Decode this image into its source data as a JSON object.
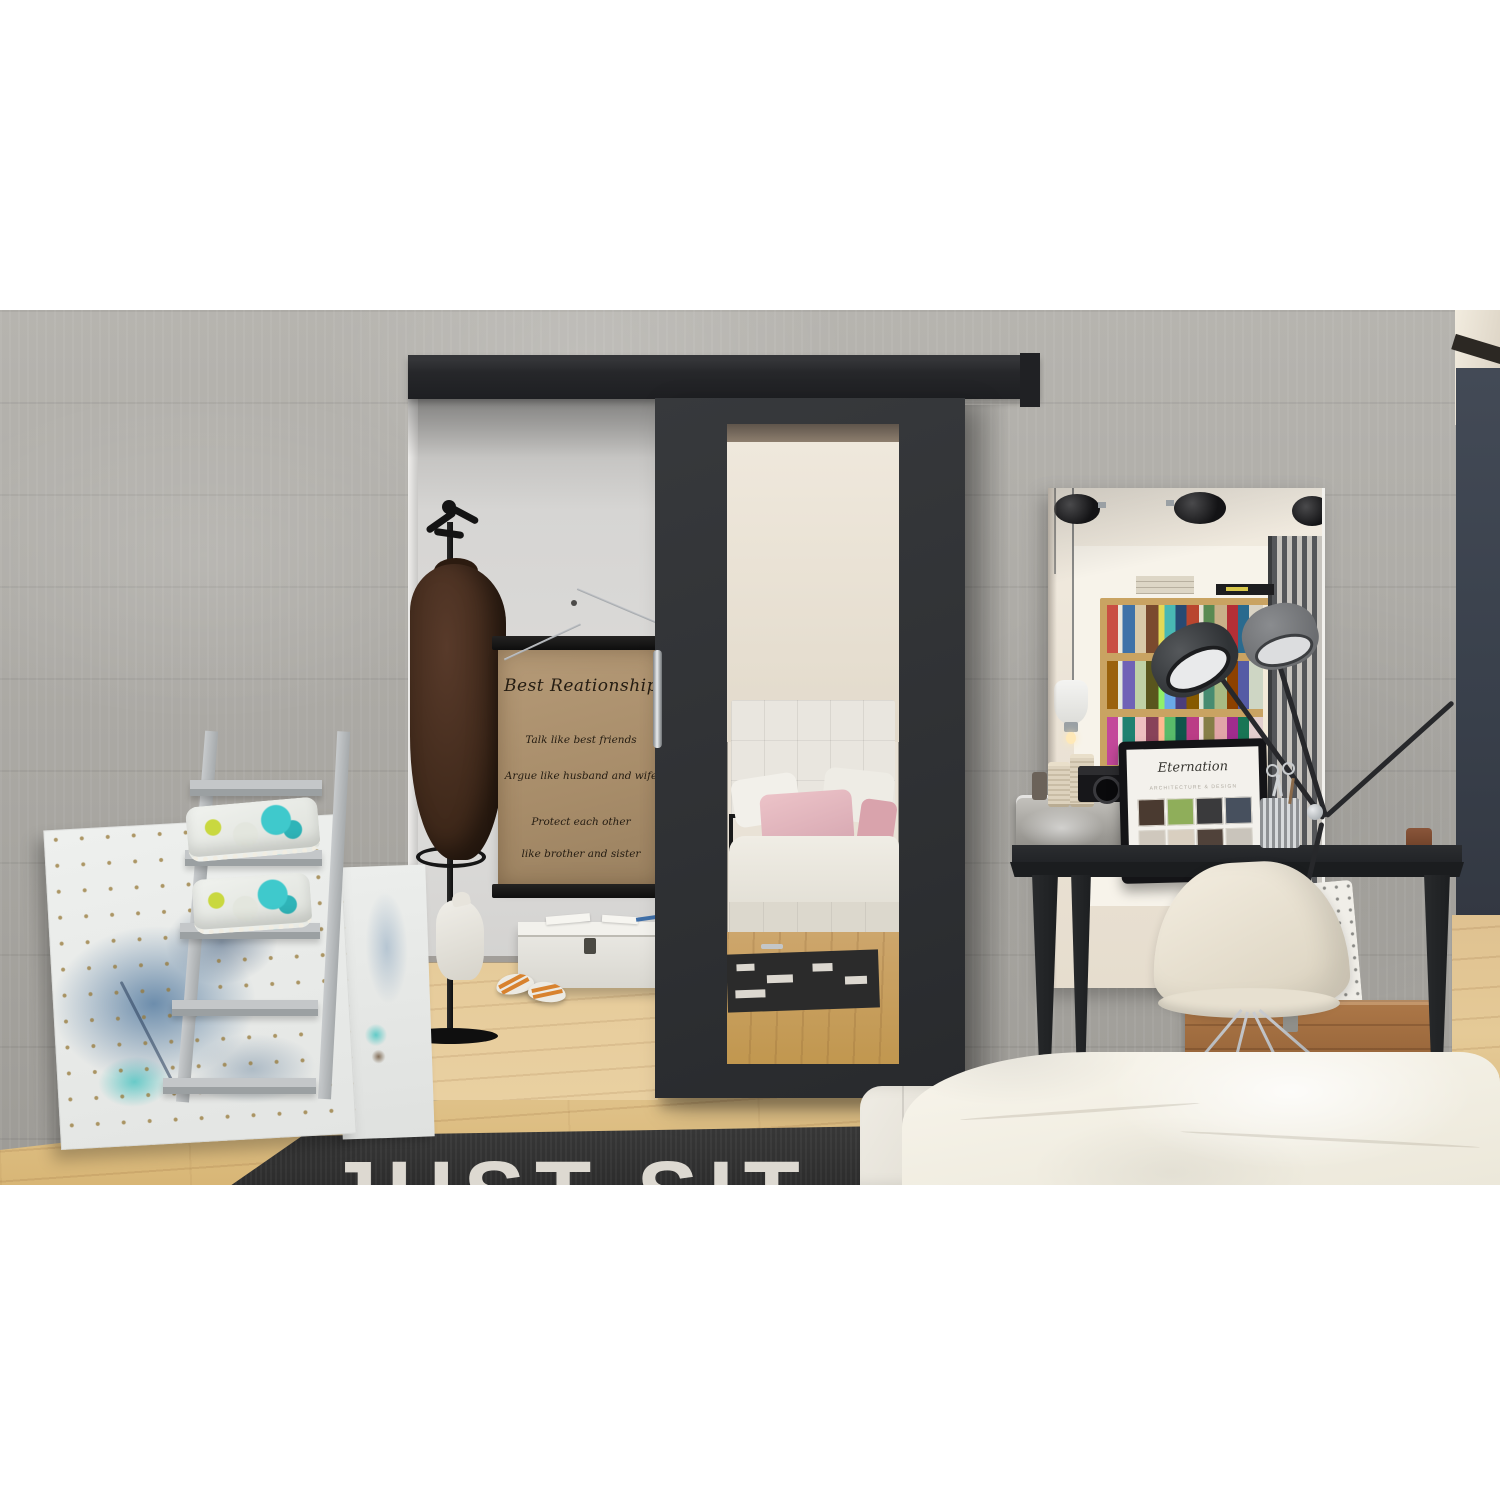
{
  "scene": {
    "kind": "interior product photograph",
    "subject": "black sliding door with mirror panel in a loft bedroom hallway"
  },
  "poster": {
    "title": "Best Reationship",
    "line1": "Talk like best friends",
    "line2": "Argue like husband and wife",
    "line3": "Protect each other",
    "line4": "like brother and sister"
  },
  "rug": {
    "text": "JUST SIT"
  },
  "laptop": {
    "brand": "Eternation",
    "subtitle": "ARCHITECTURE & DESIGN"
  },
  "colors": {
    "door": "#313335",
    "track": "#26272a",
    "concrete_wall": "#aaa8a3",
    "wood_floor": "#e0c292",
    "navy_wall": "#3b414c",
    "accent_teal": "#3fc9cc",
    "accent_lime": "#c9d83f",
    "pillow_pink": "#e2b4bc",
    "crate_wood": "#9c6b43"
  }
}
